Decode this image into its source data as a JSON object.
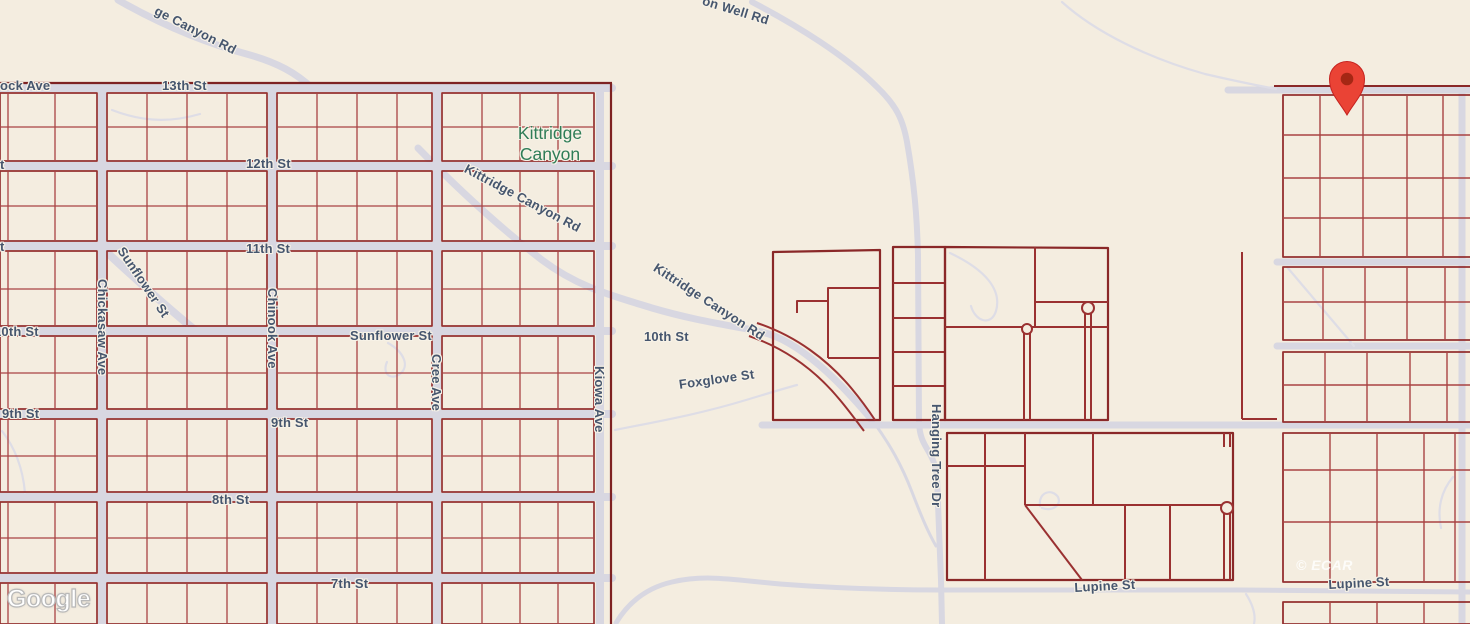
{
  "colors": {
    "background": "#f4ede0",
    "parcel_line": "#9a3131",
    "parcel_line_dark": "#7e2222",
    "road": "#d8d7e1",
    "street_label": "#46566e",
    "place_label": "#2f7d57",
    "pin": "#EA4335",
    "pin_center": "#A52714"
  },
  "place_label": {
    "line1": "Kittridge",
    "line2": "Canyon"
  },
  "street_labels": {
    "rock_ave_partial": "ock Ave",
    "thirteenth_st": "13th St",
    "canyon_rd_partial": "ge Canyon Rd",
    "well_rd_partial": "on Well Rd",
    "twelfth_st": "12th St",
    "twelfth_st_edge_fragment": "t",
    "eleventh_st": "11th St",
    "eleventh_st_edge_fragment": "t",
    "kittridge_canyon_rd_upper": "Kittridge Canyon Rd",
    "kittridge_canyon_rd_lower": "Kittridge Canyon Rd",
    "sunflower_st_diagonal": "Sunflower St",
    "chickasaw_ave": "Chickasaw Ave",
    "chinook_ave": "Chinook Ave",
    "tenth_st_left": "10th St",
    "sunflower_st": "Sunflower St",
    "cree_ave": "Cree Ave",
    "kiowa_ave": "Kiowa Ave",
    "tenth_st_mid": "10th St",
    "foxglove_st": "Foxglove St",
    "ninth_st_left": "9th St",
    "ninth_st_mid": "9th St",
    "st_edge_fragment": "St",
    "eighth_st": "8th St",
    "seventh_st": "7th St",
    "hanging_tree_dr": "Hanging Tree Dr",
    "lupine_st_west": "Lupine St",
    "lupine_st_east": "Lupine St"
  },
  "attribution": {
    "logo": "Google",
    "watermark": "© ECAR"
  },
  "marker": {
    "type": "map-pin"
  }
}
